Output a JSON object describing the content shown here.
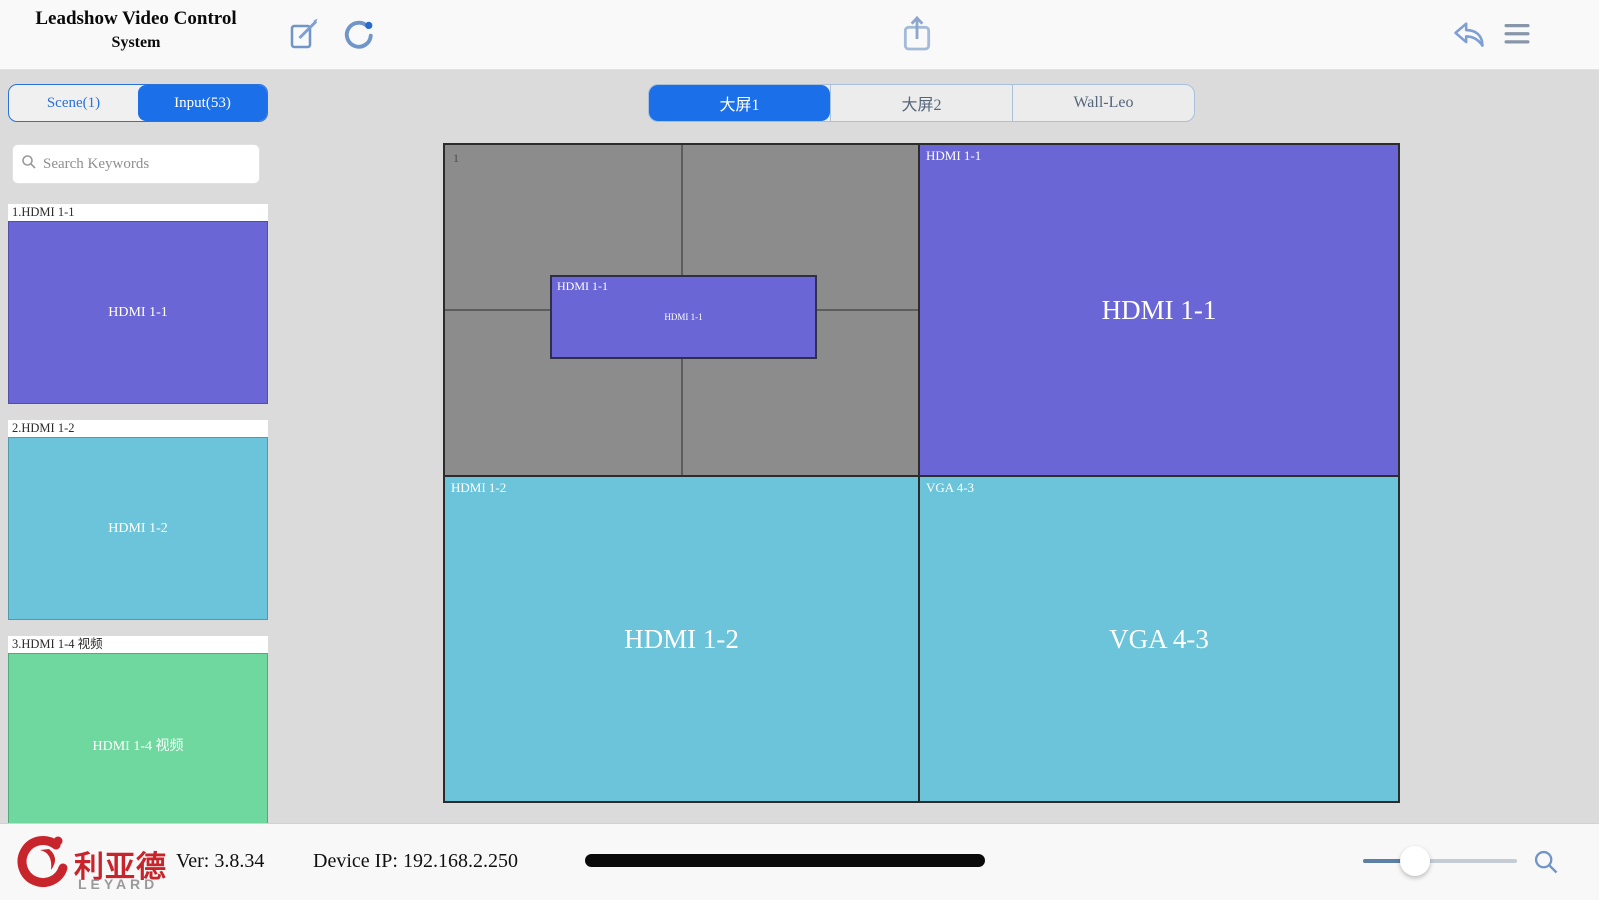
{
  "app": {
    "title_line1": "Leadshow Video Control",
    "title_line2": "System"
  },
  "toolbar": {
    "icons": [
      "edit-icon",
      "refresh-icon",
      "upload-icon",
      "undo-icon",
      "menu-icon"
    ]
  },
  "sidebar": {
    "tabs": [
      {
        "label": "Scene(1)",
        "active": false
      },
      {
        "label": "Input(53)",
        "active": true
      }
    ],
    "search_placeholder": "Search Keywords",
    "inputs": [
      {
        "index_label": "1.HDMI 1-1",
        "name": "HDMI 1-1",
        "color": "#6a66d6"
      },
      {
        "index_label": "2.HDMI 1-2",
        "name": "HDMI 1-2",
        "color": "#6cc4da"
      },
      {
        "index_label": "3.HDMI 1-4 视频",
        "name": "HDMI 1-4 视频",
        "color": "#6ed89f"
      }
    ]
  },
  "wall_tabs": [
    {
      "label": "大屏1",
      "active": true
    },
    {
      "label": "大屏2",
      "active": false
    },
    {
      "label": "Wall-Leo",
      "active": false
    }
  ],
  "canvas": {
    "screen_number": "1",
    "floating_window": {
      "corner_label": "HDMI 1-1",
      "title": "HDMI 1-1",
      "color": "#6a66d6"
    },
    "windows": [
      {
        "corner_label": "HDMI 1-1",
        "title": "HDMI 1-1",
        "color": "#6a66d6",
        "position": "top-right"
      },
      {
        "corner_label": "HDMI 1-2",
        "title": "HDMI 1-2",
        "color": "#6cc4da",
        "position": "bottom-left"
      },
      {
        "corner_label": "VGA 4-3",
        "title": "VGA 4-3",
        "color": "#6cc4da",
        "position": "bottom-right"
      }
    ]
  },
  "statusbar": {
    "logo_cn": "利亚德",
    "logo_en": "LEYARD",
    "version": "Ver: 3.8.34",
    "device_ip": "Device IP: 192.168.2.250",
    "zoom_slider_percent": 30
  },
  "colors": {
    "accent_blue": "#1b6fe8",
    "icon_blue": "#7096c8",
    "purple": "#6a66d6",
    "cyan": "#6cc4da",
    "green": "#6ed89f",
    "canvas_gray": "#8c8c8c",
    "logo_red": "#c8242b"
  }
}
